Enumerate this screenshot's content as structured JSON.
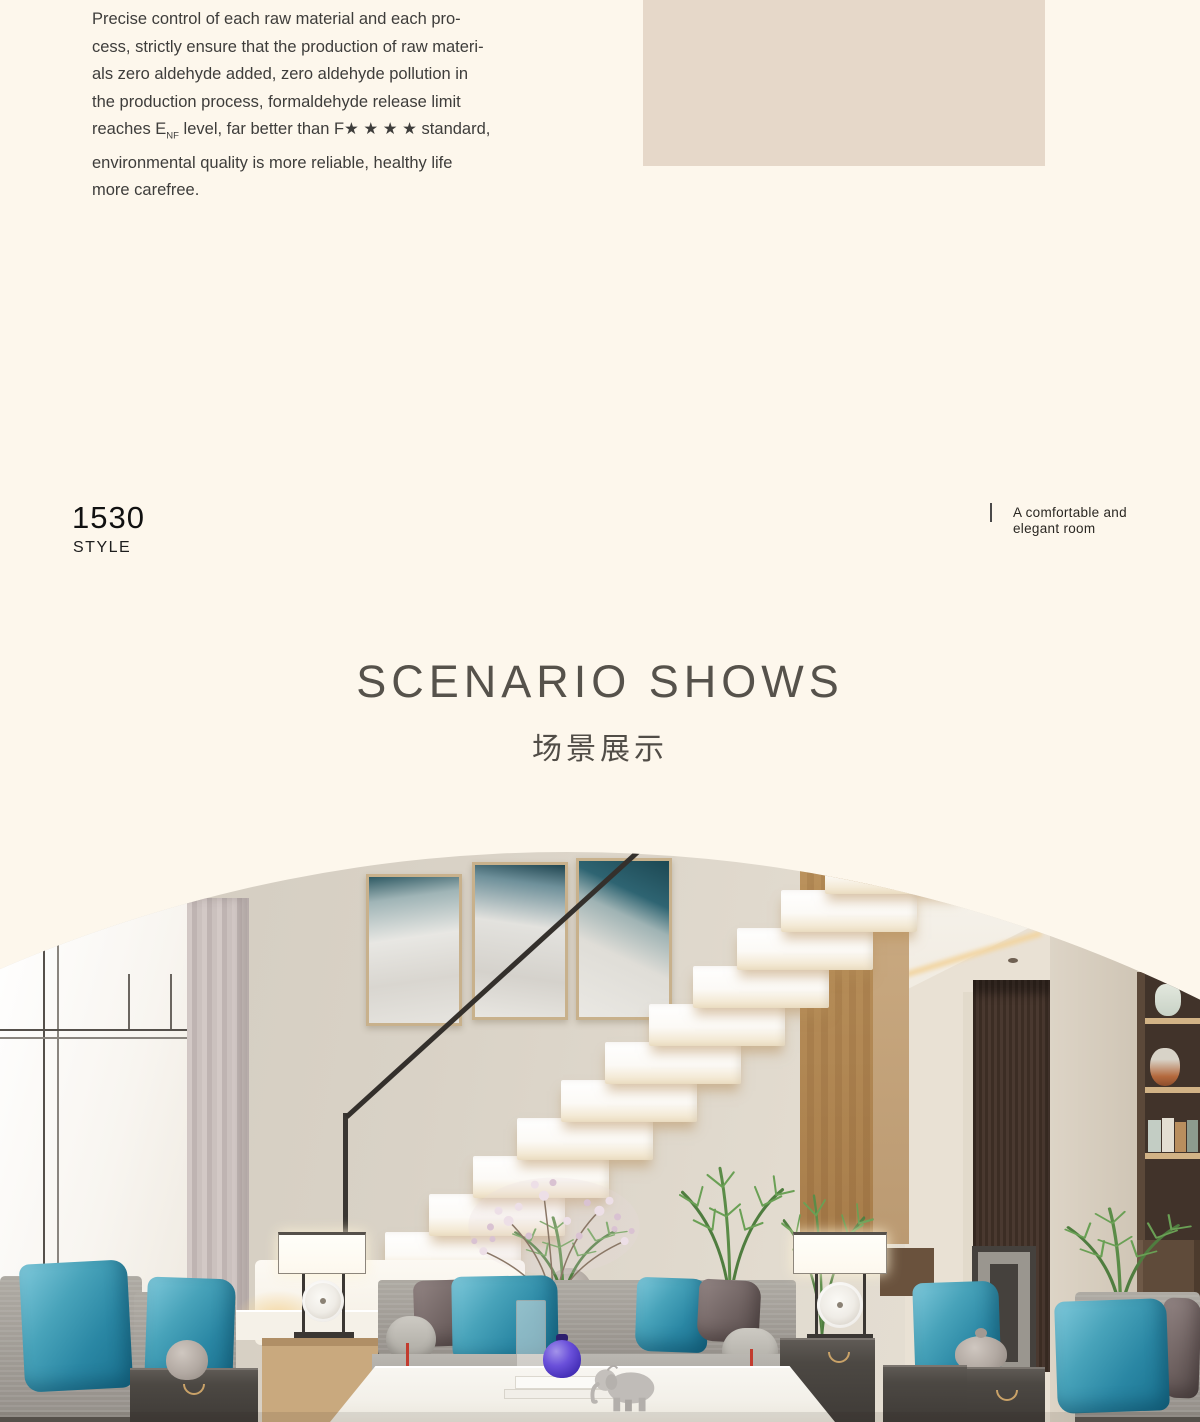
{
  "intro": {
    "lines_before": [
      "Precise control of each raw material and each pro-",
      "cess, strictly ensure that the production of raw materi-",
      "als zero aldehyde added, zero aldehyde pollution in",
      "the production process, formaldehyde release limit"
    ],
    "enf_line": {
      "pre": "reaches E",
      "sub": "NF",
      "post": " level, far better than F★ ★ ★ ★ standard,"
    },
    "lines_after": [
      "environmental quality is more reliable, healthy life",
      "more carefree."
    ]
  },
  "style_badge": {
    "number": "1530",
    "label": "STYLE"
  },
  "room_caption": {
    "text": "A comfortable and elegant room"
  },
  "section_heading": {
    "en": "SCENARIO SHOWS",
    "zh": "场景展示"
  },
  "colors": {
    "page_background": "#fdf7ec",
    "beige_panel": "#e6d8c9",
    "heading_gray": "#56524b",
    "body_text": "#3e3d3b",
    "wall_greige": "#d9d2c6",
    "teal_pillow": "#2f89a7",
    "charcoal_pillow": "#6b5f5e",
    "sofa_gray": "#a5a19b",
    "wood_panel": "#d6bb93",
    "door_brown": "#42322a",
    "stair_white": "#fdfcf9",
    "purple_jar": "#5b3fd0",
    "tassel_red": "#c23b2e"
  }
}
